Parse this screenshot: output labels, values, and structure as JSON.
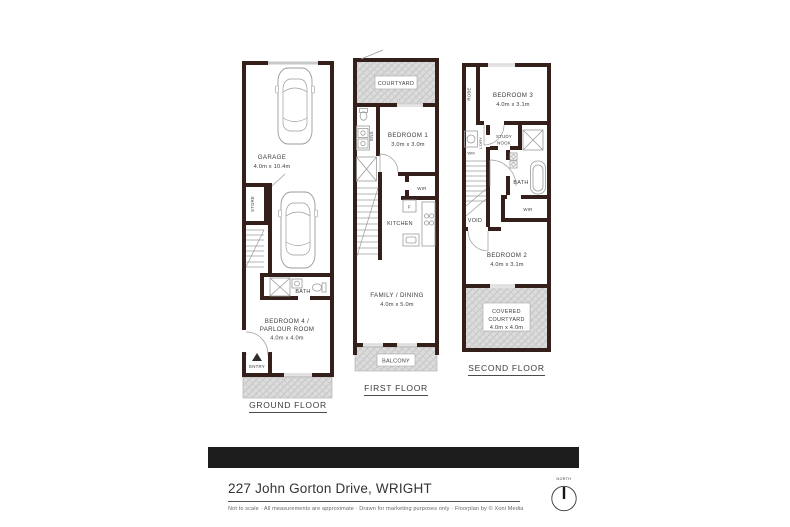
{
  "footer": {
    "address": "227 John Gorton Drive, WRIGHT",
    "disclaimer": "Not to scale  ·  All measurements are approximate  ·  Drawn for marketing purposes only  ·  Floorplan by © Xoni Media",
    "compass_label": "NORTH"
  },
  "ground": {
    "title": "GROUND FLOOR",
    "garage_name": "GARAGE",
    "garage_dims": "4.0m x 10.4m",
    "store_label": "STORE",
    "bath_label": "BATH",
    "bedroom4_line1": "BEDROOM 4 /",
    "bedroom4_line2": "PARLOUR ROOM",
    "bedroom4_dims": "4.0m x 4.0m",
    "entry_label": "ENTRY"
  },
  "first": {
    "title": "FIRST FLOOR",
    "courtyard_label": "COURTYARD",
    "ens_label": "ENS",
    "bedroom1_name": "BEDROOM 1",
    "bedroom1_dims": "3.0m x 3.0m",
    "wir_label": "WIR",
    "fridge_label": "F",
    "kitchen_label": "KITCHEN",
    "family_name": "FAMILY / DINING",
    "family_dims": "4.0m x 5.0m",
    "balcony_label": "BALCONY"
  },
  "second": {
    "title": "SECOND FLOOR",
    "robe_label": "ROBE",
    "bedroom3_name": "BEDROOM 3",
    "bedroom3_dims": "4.0m x 3.1m",
    "wm_label": "WM",
    "laundry_label": "L'DRY",
    "study_line1": "STUDY",
    "study_line2": "NOOK",
    "bath_label": "BATH",
    "void_label": "VOID",
    "wir_label": "WIR",
    "bedroom2_name": "BEDROOM 2",
    "bedroom2_dims": "4.0m x 3.1m",
    "courtyard_line1": "COVERED",
    "courtyard_line2": "COURTYARD",
    "courtyard_dims": "4.0m x 4.0m"
  },
  "colors": {
    "wall": "#351f1b",
    "banner": "#1d1d1d",
    "hatch_fill": "#dcdcdc"
  }
}
